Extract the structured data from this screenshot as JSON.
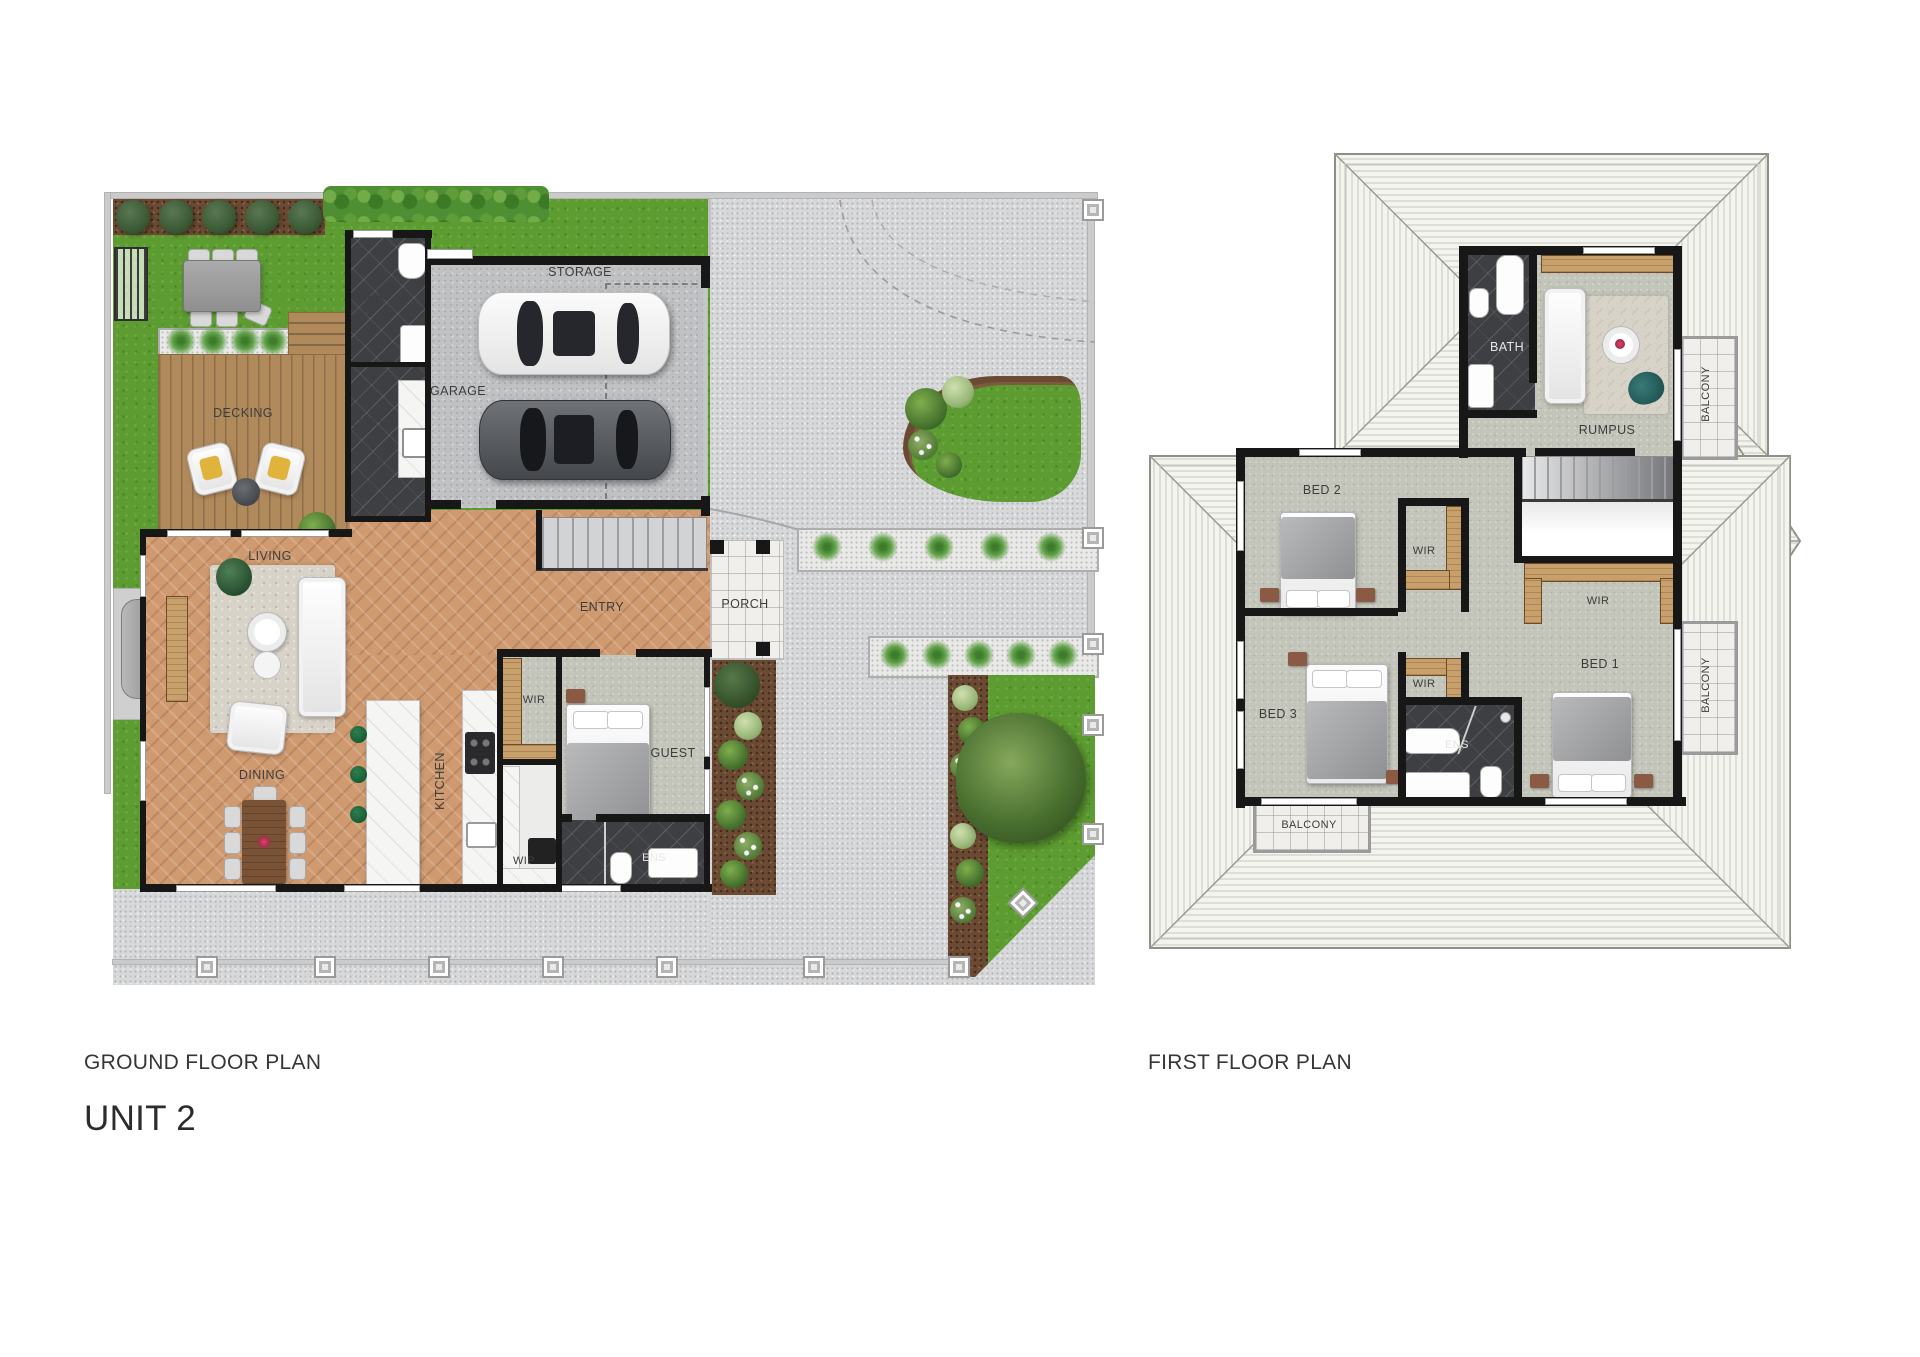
{
  "titles": {
    "ground_floor": "GROUND FLOOR PLAN",
    "first_floor": "FIRST FLOOR PLAN",
    "unit": "UNIT 2"
  },
  "ground_floor": {
    "rooms": {
      "storage": "STORAGE",
      "pwd": "PWD",
      "ldry": "L'DRY",
      "garage": "GARAGE",
      "decking": "DECKING",
      "living": "LIVING",
      "dining": "DINING",
      "kitchen": "KITCHEN",
      "entry": "ENTRY",
      "porch": "PORCH",
      "wir": "WIR",
      "guest": "GUEST",
      "wip": "WIP",
      "ens": "ENS"
    }
  },
  "first_floor": {
    "rooms": {
      "bath": "BATH",
      "rumpus": "RUMPUS",
      "bed1": "BED 1",
      "bed2": "BED 2",
      "bed3": "BED 3",
      "wir_bed1": "WIR",
      "wir_bed2": "WIR",
      "wir_bed3": "WIR",
      "ens": "ENS",
      "balcony_top": "BALCONY",
      "balcony_right": "BALCONY",
      "balcony_bottom": "BALCONY"
    }
  },
  "colors": {
    "lawn": "#5d9c30",
    "driveway": "#d7d8d9",
    "timber_floor": "#cf9a70",
    "decking": "#b18a5c",
    "carpet": "#c3c5ba",
    "dark_tile": "#3e3f43",
    "wall": "#171717",
    "roof_base": "#f4f4ef",
    "label_text": "#3d3d3d"
  }
}
